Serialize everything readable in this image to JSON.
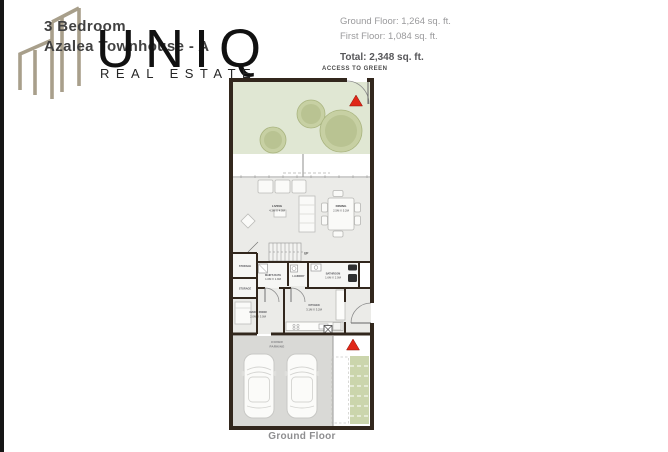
{
  "brand": {
    "name": "UNIQ",
    "tagline": "REAL ESTATE",
    "logo_icon": "buildings-outline-icon",
    "logo_color": "#a89f8b"
  },
  "listing": {
    "title_line1": "3 Bedroom",
    "title_line2": "Azalea Townhouse - A"
  },
  "areas": {
    "ground_floor": "Ground Floor: 1,264 sq. ft.",
    "first_floor": "First Floor: 1,084 sq. ft.",
    "total": "Total: 2,348 sq. ft."
  },
  "plan": {
    "access_label": "ACCESS TO GREEN",
    "caption": "Ground Floor",
    "stairs_label": "UP",
    "rooms": {
      "living": {
        "name": "LIVING",
        "dims": "4.3M X 4.0M"
      },
      "dining": {
        "name": "DINING",
        "dims": "2.5M X 5.2M"
      },
      "storage_upper": {
        "name": "STORAGE"
      },
      "storage_lower": {
        "name": "STORAGE"
      },
      "maids_bath": {
        "name": "MAID'S BATH",
        "dims": "1.0M X 1.9M"
      },
      "laundry": {
        "name": "LAUNDRY"
      },
      "bathroom": {
        "name": "BATHROOM",
        "dims": "1.6M X 2.0M"
      },
      "maids_room": {
        "name": "MAID'S ROOM",
        "dims": "2.0M X 3.0M"
      },
      "kitchen": {
        "name": "KITCHEN",
        "dims": "3.1M X 3.2M"
      },
      "parking": {
        "line1": "COVER",
        "line2": "PARKING"
      }
    },
    "colors": {
      "wall": "#32271d",
      "garden": "#e0e7d3",
      "tree": "#b9c392",
      "interior": "#ebebe8",
      "parking_floor": "#d9d9d6",
      "entry_path": "#cbd5ac",
      "entrance_marker": "#e02718"
    }
  }
}
